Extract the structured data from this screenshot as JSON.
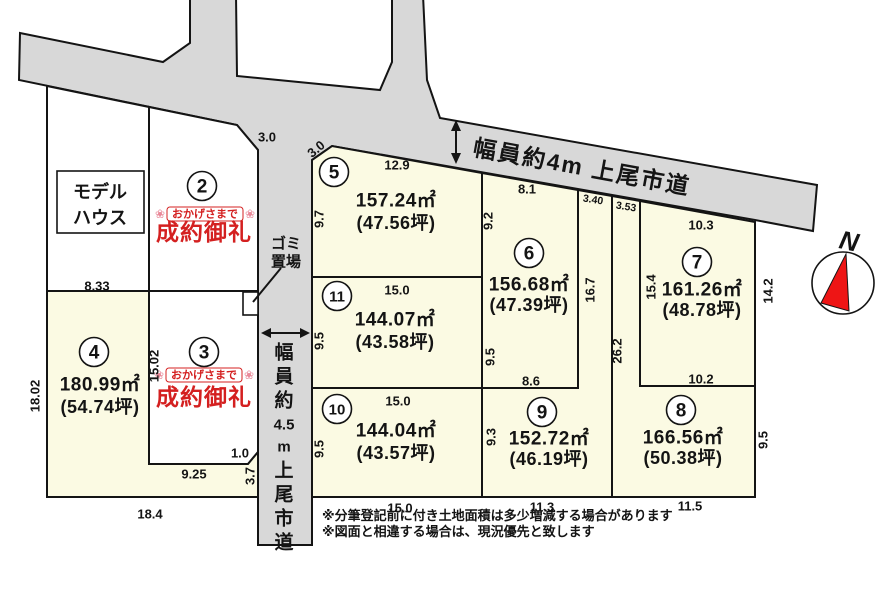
{
  "colors": {
    "road": "#d8d8d8",
    "plot_fill": "#fbfae3",
    "sold_fill": "#ffffff",
    "line": "#141414",
    "red": "#d42020",
    "compass_red": "#ee1515"
  },
  "roads": {
    "top": {
      "label": "幅員約4m 上尾市道"
    },
    "side": {
      "label": "幅員約4.5m上尾市道",
      "chars": [
        "幅",
        "員",
        "約",
        "4.5",
        "m",
        "上",
        "尾",
        "市",
        "道"
      ]
    }
  },
  "compass": {
    "label": "N"
  },
  "model_house": {
    "line1": "モデル",
    "line2": "ハウス"
  },
  "garbage": {
    "line1": "ゴミ",
    "line2": "置場"
  },
  "banner": {
    "thanks": "おかげさまで",
    "sold": "成約御礼",
    "flower": "❀"
  },
  "notes": {
    "line1": "※分筆登記前に付き土地面積は多少増減する場合があります",
    "line2": "※図面と相違する場合は、現況優先と致します"
  },
  "plots": {
    "p2": {
      "number": "2"
    },
    "p3": {
      "number": "3"
    },
    "p4": {
      "number": "4",
      "area": "180.99㎡",
      "tsubo": "(54.74坪)"
    },
    "p5": {
      "number": "5",
      "area": "157.24㎡",
      "tsubo": "(47.56坪)"
    },
    "p6": {
      "number": "6",
      "area": "156.68㎡",
      "tsubo": "(47.39坪)"
    },
    "p7": {
      "number": "7",
      "area": "161.26㎡",
      "tsubo": "(48.78坪)"
    },
    "p8": {
      "number": "8",
      "area": "166.56㎡",
      "tsubo": "(50.38坪)"
    },
    "p9": {
      "number": "9",
      "area": "152.72㎡",
      "tsubo": "(46.19坪)"
    },
    "p10": {
      "number": "10",
      "area": "144.04㎡",
      "tsubo": "(43.57坪)"
    },
    "p11": {
      "number": "11",
      "area": "144.07㎡",
      "tsubo": "(43.58坪)"
    }
  },
  "dimensions": [
    "3.0",
    "3.0",
    "12.9",
    "9.7",
    "8.33",
    "15.0",
    "9.5",
    "15.0",
    "9.5",
    "15.0",
    "18.02",
    "15.02",
    "9.25",
    "1.0",
    "3.7",
    "18.4",
    "8.1",
    "9.2",
    "3.40",
    "3.53",
    "10.3",
    "16.7",
    "15.4",
    "14.2",
    "26.2",
    "9.5",
    "8.6",
    "10.2",
    "9.3",
    "9.5",
    "11.3",
    "11.5"
  ]
}
